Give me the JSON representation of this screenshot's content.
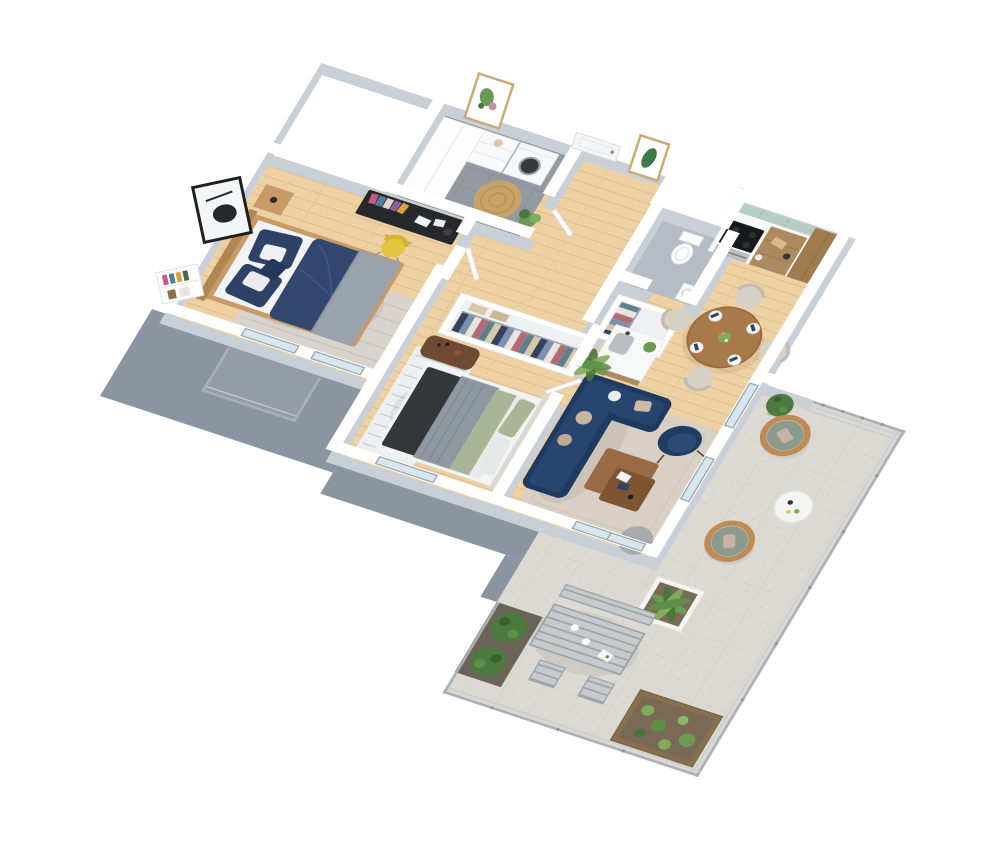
{
  "palette": {
    "wall_top": "#ffffff",
    "wall_side": "#c9cfd6",
    "slate": "#8b94a1",
    "balcony_floor": "#949ca7",
    "wood": "#edd1a3",
    "wood_line": "#dcb988",
    "tile": "#939aa2",
    "tile_line": "#848b94",
    "wc_floor": "#b6bcc3",
    "concrete": "#dcd9d2",
    "concrete_line": "#cdc9c1",
    "glass": "#cfe2eb",
    "frame_gray": "#9aa3ab",
    "railing": "#a9b0b7",
    "railing_light": "#c6ccd2",
    "sofa": "#1e3a60",
    "sofa_cushion": "#27456f",
    "armchair": "#1f3c63",
    "pillow_beige": "#cbb59f",
    "bed1_duvet": "#32476e",
    "bed1_pillow": "#2e4166",
    "blanket_gray": "#9aa2ab",
    "bed_wood": "#c79a66",
    "mattress": "#f2f3f4",
    "bed2_dark": "#33373a",
    "bed2_gray": "#9099a1",
    "bed2_sage": "#a9b595",
    "headboard_fabric": "#ddd8cf",
    "rug_living": "#d9d0c5",
    "rug_bed1": "#d8d4cd",
    "rug_stripe": "#eceff0",
    "jute": "#c7a368",
    "rug_gray": "#a6abae",
    "kitchen_green": "#b5cdc4",
    "cabinet_wood": "#ad8a5e",
    "counter": "#f7f8f8",
    "cooktop": "#17191c",
    "steel": "#b9bec3",
    "dining_wood": "#a87a4b",
    "chair_beige": "#d7d1c5",
    "napkin": "#2e4468",
    "coffee_table_top": "#9a6a44",
    "coffee_table_shelf": "#7e5433",
    "rattan": "#bf8b55",
    "cushion_sage": "#8d9a8e",
    "blush": "#c8b3a6",
    "green": "#6b9a55",
    "green_dark": "#49763c",
    "topiary": "#4e7a3f",
    "hedge": "#4c7a3e",
    "desk": "#26282b",
    "chair_yellow": "#e5c43e",
    "walnut": "#6e4a33",
    "table_white": "#f4f4f2",
    "soil": "#7a6a55",
    "planter_wood": "#8a6f4d",
    "door_white": "#f4f5f6",
    "clothes_1": "#33415e",
    "clothes_2": "#7b8fae",
    "clothes_3": "#e8e4de",
    "clothes_4": "#b46a73",
    "clothes_5": "#5e7f8d",
    "clothes_6": "#d8c9a8"
  },
  "scene": {
    "type": "isometric-apartment-floorplan-render",
    "rooms": [
      {
        "name": "bathroom",
        "items": [
          "tall-cabinet",
          "drawer-unit",
          "washing-machine",
          "jute-rug",
          "potted-plant",
          "floral-wall-art"
        ]
      },
      {
        "name": "hallway",
        "items": [
          "front-door",
          "leaf-wall-art",
          "utility-shaft"
        ]
      },
      {
        "name": "wc",
        "items": [
          "toilet",
          "corner-sink"
        ]
      },
      {
        "name": "bedroom-1",
        "items": [
          "navy-double-bed",
          "nightstand",
          "desk",
          "yellow-desk-chair",
          "abstract-wall-art",
          "wall-shelf",
          "area-rug",
          "balcony-door",
          "window"
        ]
      },
      {
        "name": "bedroom-2",
        "items": [
          "bed-with-sage-gray-bedding",
          "walnut-sideboard",
          "striped-rug",
          "window"
        ]
      },
      {
        "name": "storage",
        "items": [
          "open-wardrobe-long",
          "open-wardrobe-short"
        ]
      },
      {
        "name": "kitchen",
        "items": [
          "green-upper-cabinets",
          "wood-base-cabinets",
          "cooktop",
          "oven",
          "tall-cabinet",
          "island-with-sink"
        ]
      },
      {
        "name": "dining",
        "items": [
          "round-wood-table",
          "four-beige-chairs",
          "place-settings",
          "centerpiece"
        ]
      },
      {
        "name": "living-room",
        "items": [
          "navy-corner-sofa",
          "two-tier-coffee-table",
          "beige-rug",
          "navy-armchair",
          "palm-plant",
          "gray-round-rug",
          "glass-slider"
        ]
      },
      {
        "name": "terrace-upper",
        "items": [
          "egg-chair",
          "egg-chair",
          "white-round-table",
          "topiary",
          "railing"
        ]
      },
      {
        "name": "terrace-lower",
        "items": [
          "metal-dining-table",
          "bench",
          "two-chairs",
          "palm-planter",
          "hedge-planters",
          "herb-planter",
          "railing"
        ]
      },
      {
        "name": "bedroom-balcony",
        "items": [
          "railing"
        ]
      }
    ]
  }
}
